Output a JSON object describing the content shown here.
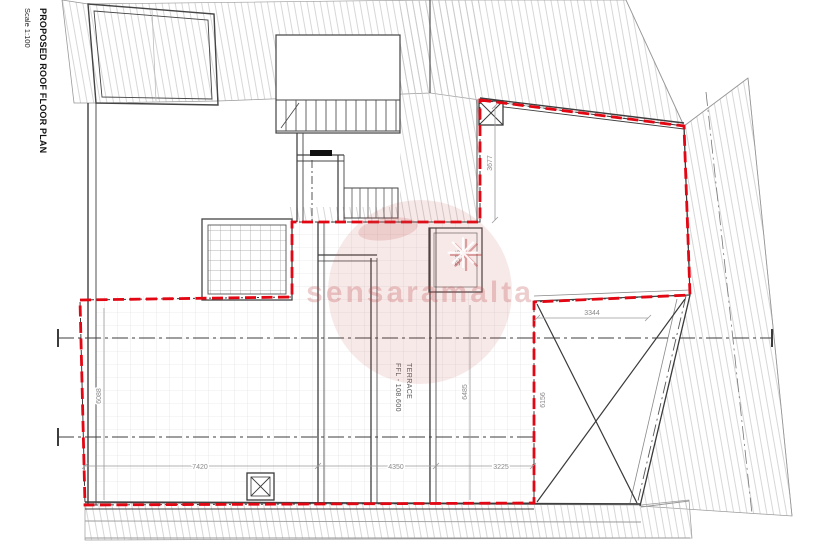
{
  "title_block": {
    "title": "PROPOSED ROOF FLOOR PLAN",
    "scale": "Scale 1:100"
  },
  "terrace_label": {
    "name": "TERRACE",
    "level": "FFL - 108.600"
  },
  "dimensions": {
    "bottom": [
      "7420",
      "4350",
      "3225"
    ],
    "upper_right_width": "3344",
    "upper_right_height": "3677",
    "shaft_height": "5515",
    "terrace_height_mid": "6485",
    "terrace_height_right": "6156",
    "terrace_height_left": "6088"
  },
  "watermark": {
    "text": "sensaramalta",
    "star": "✳"
  },
  "colors": {
    "boundary_red": "#e30613",
    "watermark_pink": "#c05050",
    "wall_dark": "#3f3f3f",
    "hatch_gray": "#c6c6c6",
    "grid_gray": "#dcdcdc",
    "dim_gray": "#8a8a8a"
  }
}
